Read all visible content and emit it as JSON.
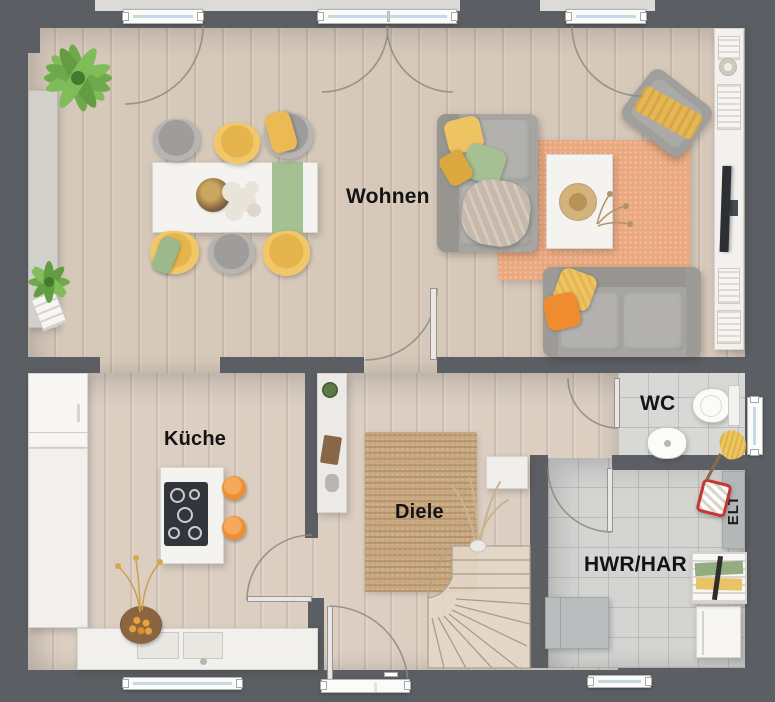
{
  "rooms": {
    "wohnen": {
      "label": "Wohnen"
    },
    "kueche": {
      "label": "Küche"
    },
    "diele": {
      "label": "Diele"
    },
    "wc": {
      "label": "WC"
    },
    "hwr": {
      "label": "HWR/HAR"
    },
    "elt": {
      "label": "ELT"
    }
  },
  "colors": {
    "wall": "#5b5e62",
    "wood_floor": "#d7c9ba",
    "tile_floor": "#d4d4d2",
    "living_rug": "#eba87e",
    "hall_rug": "#c8a77f",
    "sofa_gray": "#a6a5a1",
    "accent_yellow": "#eec463",
    "accent_green": "#a5c193",
    "accent_orange": "#ee8c2f",
    "stool_orange": "#f0943c",
    "bucket_red": "#c63731"
  },
  "furniture_icons": [
    "dining-table",
    "dining-chair",
    "sofa",
    "coffee-table",
    "armchair",
    "tv",
    "tv-sideboard",
    "sideboard",
    "kitchen-island",
    "cooktop",
    "bar-stool",
    "kitchen-sink",
    "refrigerator",
    "toilet",
    "washbasin",
    "towel",
    "washing-machine",
    "drying-rack",
    "laundry-basket",
    "electrical-panel",
    "stairs",
    "rug",
    "plant",
    "window",
    "door"
  ]
}
